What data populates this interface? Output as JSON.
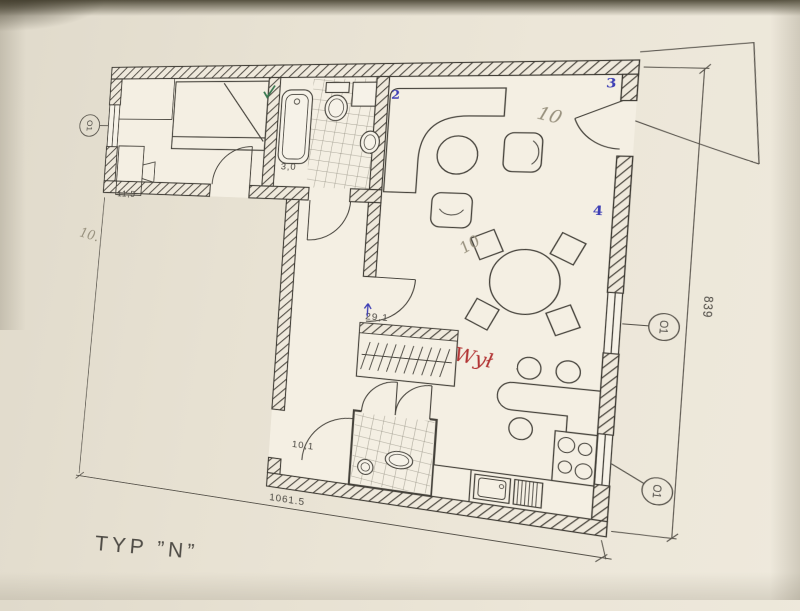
{
  "document": {
    "type_label": "TYP  ”N”"
  },
  "plan": {
    "area_labels": [
      {
        "room": "bedroom",
        "text": "11,5"
      },
      {
        "room": "bathroom",
        "text": "3,0"
      },
      {
        "room": "living",
        "text": "29,1"
      },
      {
        "room": "hall",
        "text": "10,1"
      }
    ],
    "dimensions": {
      "bottom_width": "1061.5",
      "right_height": "839"
    },
    "window_tags": {
      "left": "O1",
      "right_middle": "O1",
      "right_bottom": "O1"
    },
    "annotations": {
      "pencil_living": "10",
      "pencil_dining": "10",
      "pencil_margin": "10.",
      "red_note": "Wył",
      "blue_mark_2": "2",
      "blue_mark_3": "3",
      "blue_mark_4": "4"
    },
    "colors": {
      "paper": "#e7e1d3",
      "ink": "#45423b",
      "pencil": "#97907d",
      "red_pen": "#b23434",
      "blue_pen": "#3d3eb5",
      "green_pen": "#37784f"
    }
  }
}
